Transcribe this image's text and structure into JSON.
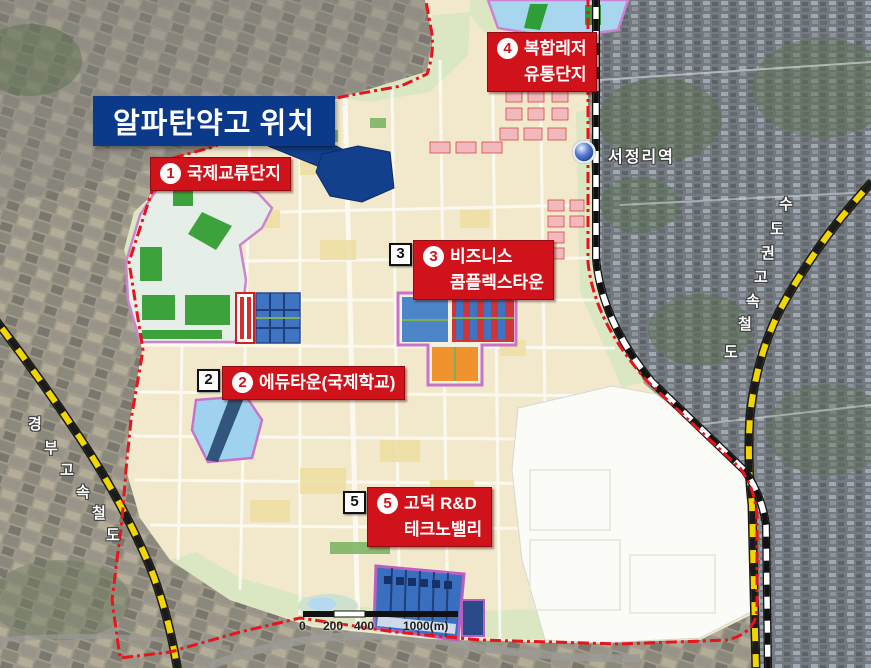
{
  "callout": {
    "text": "알파탄약고 위치"
  },
  "zones": [
    {
      "num": "1",
      "line1": "국제교류단지",
      "line2": "",
      "box_num": ""
    },
    {
      "num": "2",
      "line1": "에듀타운(국제학교)",
      "line2": "",
      "box_num": "2"
    },
    {
      "num": "3",
      "line1": "비즈니스",
      "line2": "콤플렉스타운",
      "box_num": "3"
    },
    {
      "num": "4",
      "line1": "복합레저",
      "line2": "유통단지",
      "box_num": ""
    },
    {
      "num": "5",
      "line1": "고덕 R&D",
      "line2": "테크노밸리",
      "box_num": "5"
    }
  ],
  "station": {
    "name": "서정리역"
  },
  "railways": {
    "metro": {
      "name": "수도권고속철도",
      "chars": [
        "수",
        "도",
        "권",
        "고",
        "속",
        "철",
        "도"
      ]
    },
    "gyeongbu": {
      "name": "경부고속철도",
      "chars": [
        "경",
        "부",
        "고",
        "속",
        "철",
        "도"
      ]
    }
  },
  "scalebar": {
    "t0": "0",
    "t1": "200",
    "t2": "400",
    "t3": "1000(m)"
  },
  "colors": {
    "label_red": "#d0121a",
    "callout_navy": "#0c3a8a",
    "depot_navy": "#12408c",
    "boundary_red": "#e8141c",
    "rail_yellow": "#f2d600",
    "plan_cream": "#f2e9cc",
    "zone_purple": "#c873c8",
    "water_blue": "#a8d6ef",
    "park_green": "#3da23c",
    "orange_block": "#f0922e",
    "blue_block": "#3f74c3",
    "white_plot": "#fbfbf8"
  }
}
